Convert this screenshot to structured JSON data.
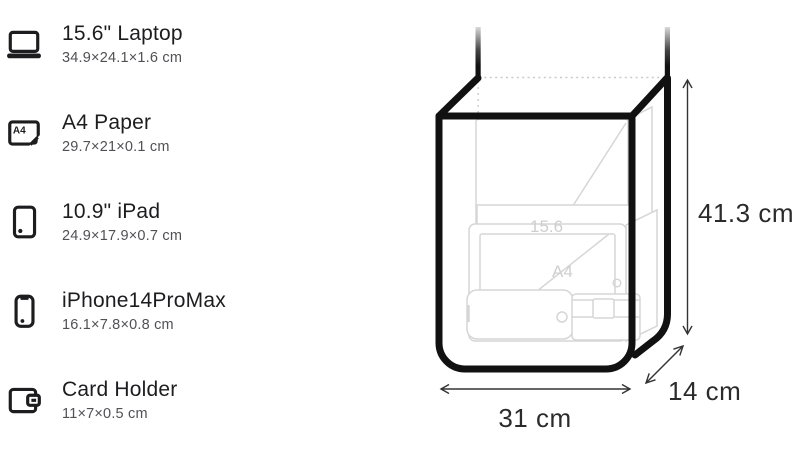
{
  "items": [
    {
      "icon": "laptop-icon",
      "title": "15.6\" Laptop",
      "dimensions": "34.9×24.1×1.6 cm"
    },
    {
      "icon": "a4-paper-icon",
      "title": "A4 Paper",
      "dimensions": "29.7×21×0.1 cm",
      "icon_label": "A4"
    },
    {
      "icon": "ipad-icon",
      "title": "10.9\" iPad",
      "dimensions": "24.9×17.9×0.7 cm"
    },
    {
      "icon": "iphone-icon",
      "title": "iPhone14ProMax",
      "dimensions": "16.1×7.8×0.8 cm"
    },
    {
      "icon": "card-holder-icon",
      "title": "Card Holder",
      "dimensions": "11×7×0.5 cm"
    }
  ],
  "diagram": {
    "height_label": "41.3 cm",
    "width_label": "31 cm",
    "depth_label": "14 cm",
    "ghost_labels": {
      "laptop": "15.6",
      "a4_paper": "A4"
    },
    "colors": {
      "outline": "#111111",
      "ghost_stroke": "#d6d6d6",
      "ghost_label": "#cfcfcf",
      "dotted_line": "#c9c9c9",
      "dimension_line": "#333333",
      "dimension_text": "#2b2b2b"
    }
  }
}
